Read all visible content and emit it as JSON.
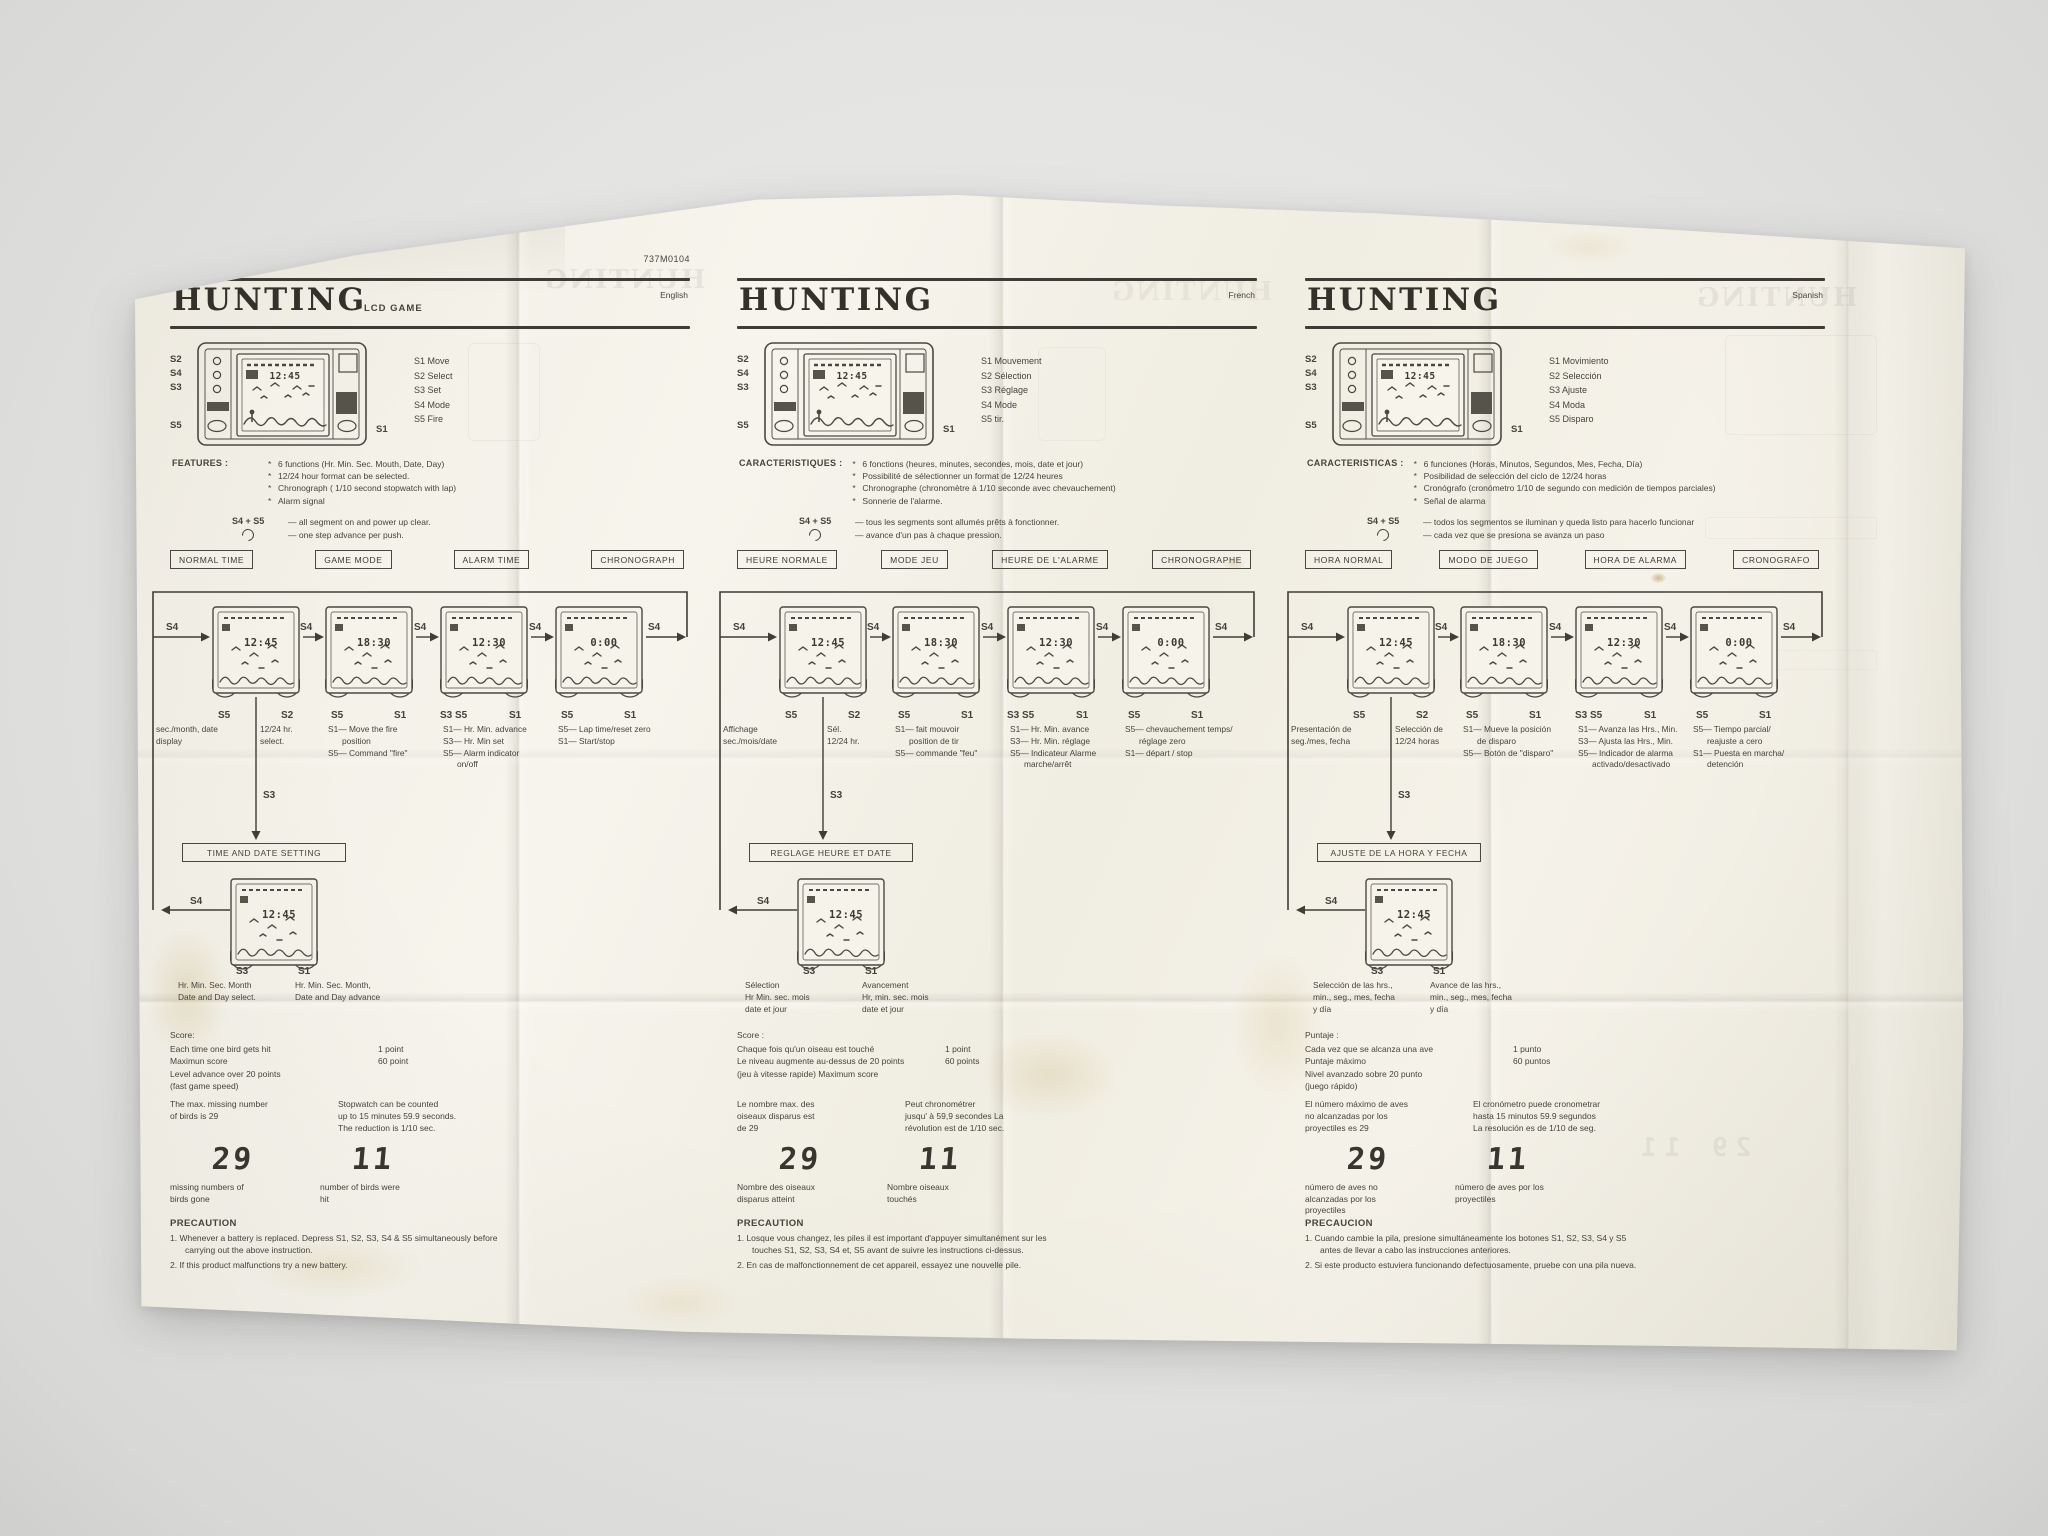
{
  "meta": {
    "part_number": "737M0104"
  },
  "ghost": {
    "title": "HUNTING",
    "nums": "29  11"
  },
  "lcd": {
    "times": [
      "12:45",
      "18:30",
      "12:30",
      "0:00",
      "12:45"
    ],
    "missed": "29",
    "hit": "11"
  },
  "diagram_labels": {
    "s4": "S4",
    "s5": "S5",
    "s2": "S2",
    "s1": "S1",
    "s3": "S3",
    "s3s5": "S3 S5"
  },
  "device_labels": {
    "s2": "S2",
    "s4": "S4",
    "s3": "S3",
    "s5": "S5",
    "s1": "S1"
  },
  "columns": [
    {
      "lang": "English",
      "code": "737M0104",
      "title": "HUNTING",
      "subtitle": "LCD GAME",
      "buttons": [
        "S1 Move",
        "S2 Select",
        "S3 Set",
        "S4 Mode",
        "S5 Fire"
      ],
      "features_head": "FEATURES :",
      "features": [
        "6 functions (Hr. Min. Sec. Mouth, Date, Day)",
        "12/24 hour format can be selected.",
        "Chronograph ( 1/10 second stopwatch with lap)",
        "Alarm signal"
      ],
      "s45_label": "S4 + S5",
      "s45_line1": "— all segment on and power up clear.",
      "s45_line2": "— one step advance per push.",
      "modes": [
        "NORMAL TIME",
        "GAME MODE",
        "ALARM TIME",
        "CHRONOGRAPH"
      ],
      "flow": {
        "d1a": "sec./month, date\ndisplay",
        "d1b": "12/24 hr.\nselect.",
        "d2": "S1— Move the fire\n      position\nS5— Command \"fire\"",
        "d3": "S1— Hr. Min. advance\nS3— Hr. Min set\nS5— Alarm indicator\n      on/off",
        "d4": "S5— Lap time/reset zero\nS1— Start/stop",
        "setting_box": "TIME AND DATE SETTING",
        "select_text": "Hr. Min. Sec. Month\nDate and Day select.",
        "advance_text": "Hr. Min. Sec. Month,\nDate and Day advance"
      },
      "score": {
        "head": "Score:",
        "rows": [
          [
            "Each time one bird gets hit",
            "1 point"
          ],
          [
            "Maximun score",
            "60 point"
          ],
          [
            "Level advance over 20 points",
            ""
          ],
          [
            "(fast game speed)",
            ""
          ]
        ]
      },
      "max_text": "The max. missing number\nof birds is 29",
      "stopwatch_text": "Stopwatch can be counted\nup to 15 minutes 59.9 seconds.\nThe reduction is 1/10 sec.",
      "cap1": "missing numbers of\nbirds gone",
      "cap2": "number of birds were\nhit",
      "precaution_head": "PRECAUTION",
      "precautions": [
        "1.  Whenever a battery is replaced. Depress S1, S2, S3, S4 & S5 simultaneously before carrying out the above instruction.",
        "2.  If this product malfunctions try a new battery."
      ]
    },
    {
      "lang": "French",
      "code": "",
      "title": "HUNTING",
      "subtitle": "",
      "buttons": [
        "S1 Mouvement",
        "S2 Sélection",
        "S3 Réglage",
        "S4 Mode",
        "S5 tir."
      ],
      "features_head": "CARACTERISTIQUES :",
      "features": [
        "6 fonctions (heures, minutes, secondes, mois, date et jour)",
        "Possibilité de sélectionner un format de 12/24 heures",
        "Chronographe (chronomètre à 1/10 seconde avec chevauchement)",
        "Sonnerie de l'alarme."
      ],
      "s45_label": "S4 + S5",
      "s45_line1": "— tous les segments sont allumés prêts à fonctionner.",
      "s45_line2": "— avance d'un pas à chaque pression.",
      "modes": [
        "HEURE NORMALE",
        "MODE JEU",
        "HEURE DE L'ALARME",
        "CHRONOGRAPHE"
      ],
      "flow": {
        "d1a": "Affichage\nsec./mois/date",
        "d1b": "Sél.\n12/24 hr.",
        "d2": "S1— fait mouvoir\n      position de tir\nS5— commande \"feu\"",
        "d3": "S1— Hr. Min. avance\nS3— Hr. Min. réglage\nS5— Indicateur Alarme\n      marche/arrêt",
        "d4": "S5— chevauchement temps/\n      réglage zero\nS1— départ / stop",
        "setting_box": "REGLAGE HEURE ET DATE",
        "select_text": "Sélection\nHr Min. sec. mois\ndate et jour",
        "advance_text": "Avancement\nHr, min. sec. mois\ndate et jour"
      },
      "score": {
        "head": "Score :",
        "rows": [
          [
            "Chaque fois qu'un oiseau est  touché",
            "1 point"
          ],
          [
            "Le niveau augmente au-dessus de 20 points",
            "60 points"
          ],
          [
            "(jeu à vitesse rapide) Maximum score",
            ""
          ]
        ]
      },
      "max_text": "Le nombre max. des\noiseaux disparus est\nde 29",
      "stopwatch_text": "Peut chronométrer\njusqu' à 59,9 secondes La\nrévolution est de 1/10 sec.",
      "cap1": "Nombre des oiseaux\ndisparus atteint",
      "cap2": "Nombre oiseaux\ntouchés",
      "precaution_head": "PRECAUTION",
      "precautions": [
        "1.  Losque vous changez, les piles il est important d'appuyer simultanément sur les touches S1, S2, S3, S4 et, S5 avant de suivre les instructions ci-dessus.",
        "2.  En cas de malfonctionnement de cet appareil, essayez une nouvelle pile."
      ]
    },
    {
      "lang": "Spanish",
      "code": "",
      "title": "HUNTING",
      "subtitle": "",
      "buttons": [
        "S1 Movimiento",
        "S2 Selección",
        "S3 Ajuste",
        "S4 Moda",
        "S5 Disparo"
      ],
      "features_head": "CARACTERISTICAS :",
      "features": [
        "6 funciones (Horas, Minutos, Segundos, Mes, Fecha, Día)",
        "Posibilidad de selección del ciclo de 12/24 horas",
        "Cronógrafo (cronómetro 1/10 de segundo con medición de tiempos parciales)",
        "Señal de alarma"
      ],
      "s45_label": "S4 + S5",
      "s45_line1": "— todos los segmentos se iluminan y queda listo para hacerlo funcionar",
      "s45_line2": "— cada vez que se presiona se avanza un paso",
      "modes": [
        "HORA NORMAL",
        "MODO DE JUEGO",
        "HORA DE ALARMA",
        "CRONOGRAFO"
      ],
      "flow": {
        "d1a": "Presentación de\nseg./mes, fecha",
        "d1b": "Selección de\n12/24 horas",
        "d2": "S1— Mueve la posición\n      de disparo\nS5— Botón de \"disparo\"",
        "d3": "S1— Avanza las Hrs., Min.\nS3— Ajusta las Hrs., Min.\nS5— Indicador de alarma\n      activado/desactivado",
        "d4": "S5— Tiempo parcial/\n      reajuste a cero\nS1— Puesta en marcha/\n      detención",
        "setting_box": "AJUSTE DE LA HORA Y FECHA",
        "select_text": "Selección de las hrs.,\nmin., seg., mes, fecha\ny día",
        "advance_text": "Avance de las hrs.,\nmin., seg., mes, fecha\ny día"
      },
      "score": {
        "head": "Puntaje :",
        "rows": [
          [
            "Cada vez que se alcanza una ave",
            "1 punto"
          ],
          [
            "Puntaje máximo",
            "60 puntos"
          ],
          [
            "Nivel avanzado sobre 20 punto",
            ""
          ],
          [
            "(juego rápido)",
            ""
          ]
        ]
      },
      "max_text": "El número máximo de aves\nno alcanzadas por los\nproyectiles es 29",
      "stopwatch_text": "El cronómetro puede cronometrar\nhasta 15 minutos 59.9 segundos\nLa resolución es de 1/10 de seg.",
      "cap1": "número de aves no\nalcanzadas por los\nproyectiles",
      "cap2": "número de aves por los\nproyectiles",
      "precaution_head": "PRECAUCION",
      "precautions": [
        "1.  Cuando cambie la pila, presione simultáneamente los botones S1, S2, S3, S4 y S5 antes de llevar a cabo las instrucciones anteriores.",
        "2.  Si este producto estuviera funcionando defectuosamente, pruebe con una pila nueva."
      ]
    }
  ]
}
